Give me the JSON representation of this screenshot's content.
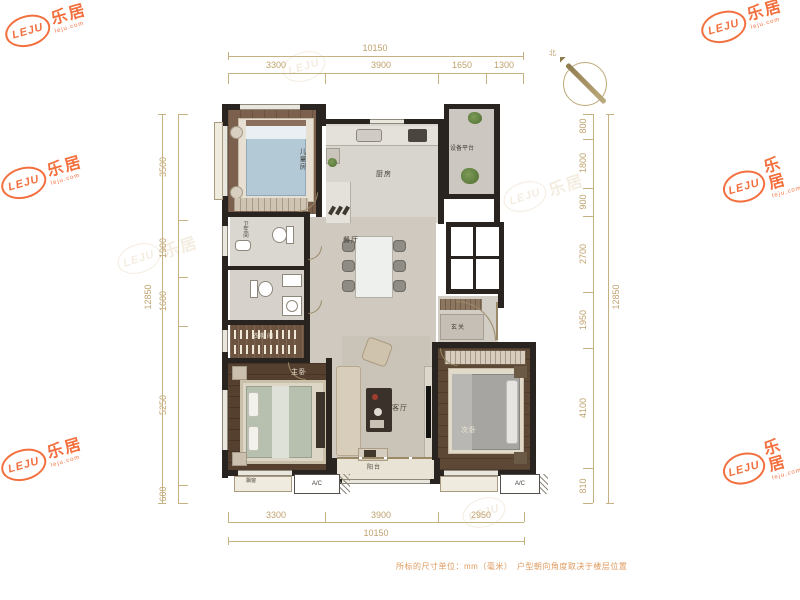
{
  "brand": {
    "cn": "乐居",
    "en": "LEJU",
    "site": "leju.com"
  },
  "compass": {
    "north_label": "北"
  },
  "footer": {
    "note": "所标的尺寸单位：mm（毫米）　户型朝向角度取决于楼层位置"
  },
  "dimensions": {
    "unit": "mm",
    "top": {
      "total": "10150",
      "segments": [
        "3300",
        "3900",
        "1650",
        "1300"
      ]
    },
    "bottom": {
      "total": "10150",
      "segments": [
        "3300",
        "3900",
        "2950"
      ]
    },
    "left": {
      "total": "12850",
      "segments": [
        "3500",
        "1900",
        "1600",
        "5250",
        "600"
      ]
    },
    "right": {
      "total": "12850",
      "segments": [
        "800",
        "1800",
        "900",
        "2700",
        "1950",
        "4100",
        "810"
      ]
    }
  },
  "rooms": {
    "kids_bedroom": "儿童房",
    "kitchen": "厨房",
    "equipment_platform": "设备平台",
    "dining": "餐厅",
    "bathroom": "卫生间",
    "cloakroom": "衣帽间",
    "master_bedroom": "主卧",
    "living": "客厅",
    "balcony": "阳台",
    "second_bedroom": "次卧",
    "entry": "玄关",
    "bay_window": "飘窗",
    "ac_left": "A/C",
    "ac_right": "A/C"
  },
  "colors": {
    "accent_orange": "#f2571d",
    "dimension_tan": "#bfa26d",
    "wall_dark": "#29241f"
  }
}
